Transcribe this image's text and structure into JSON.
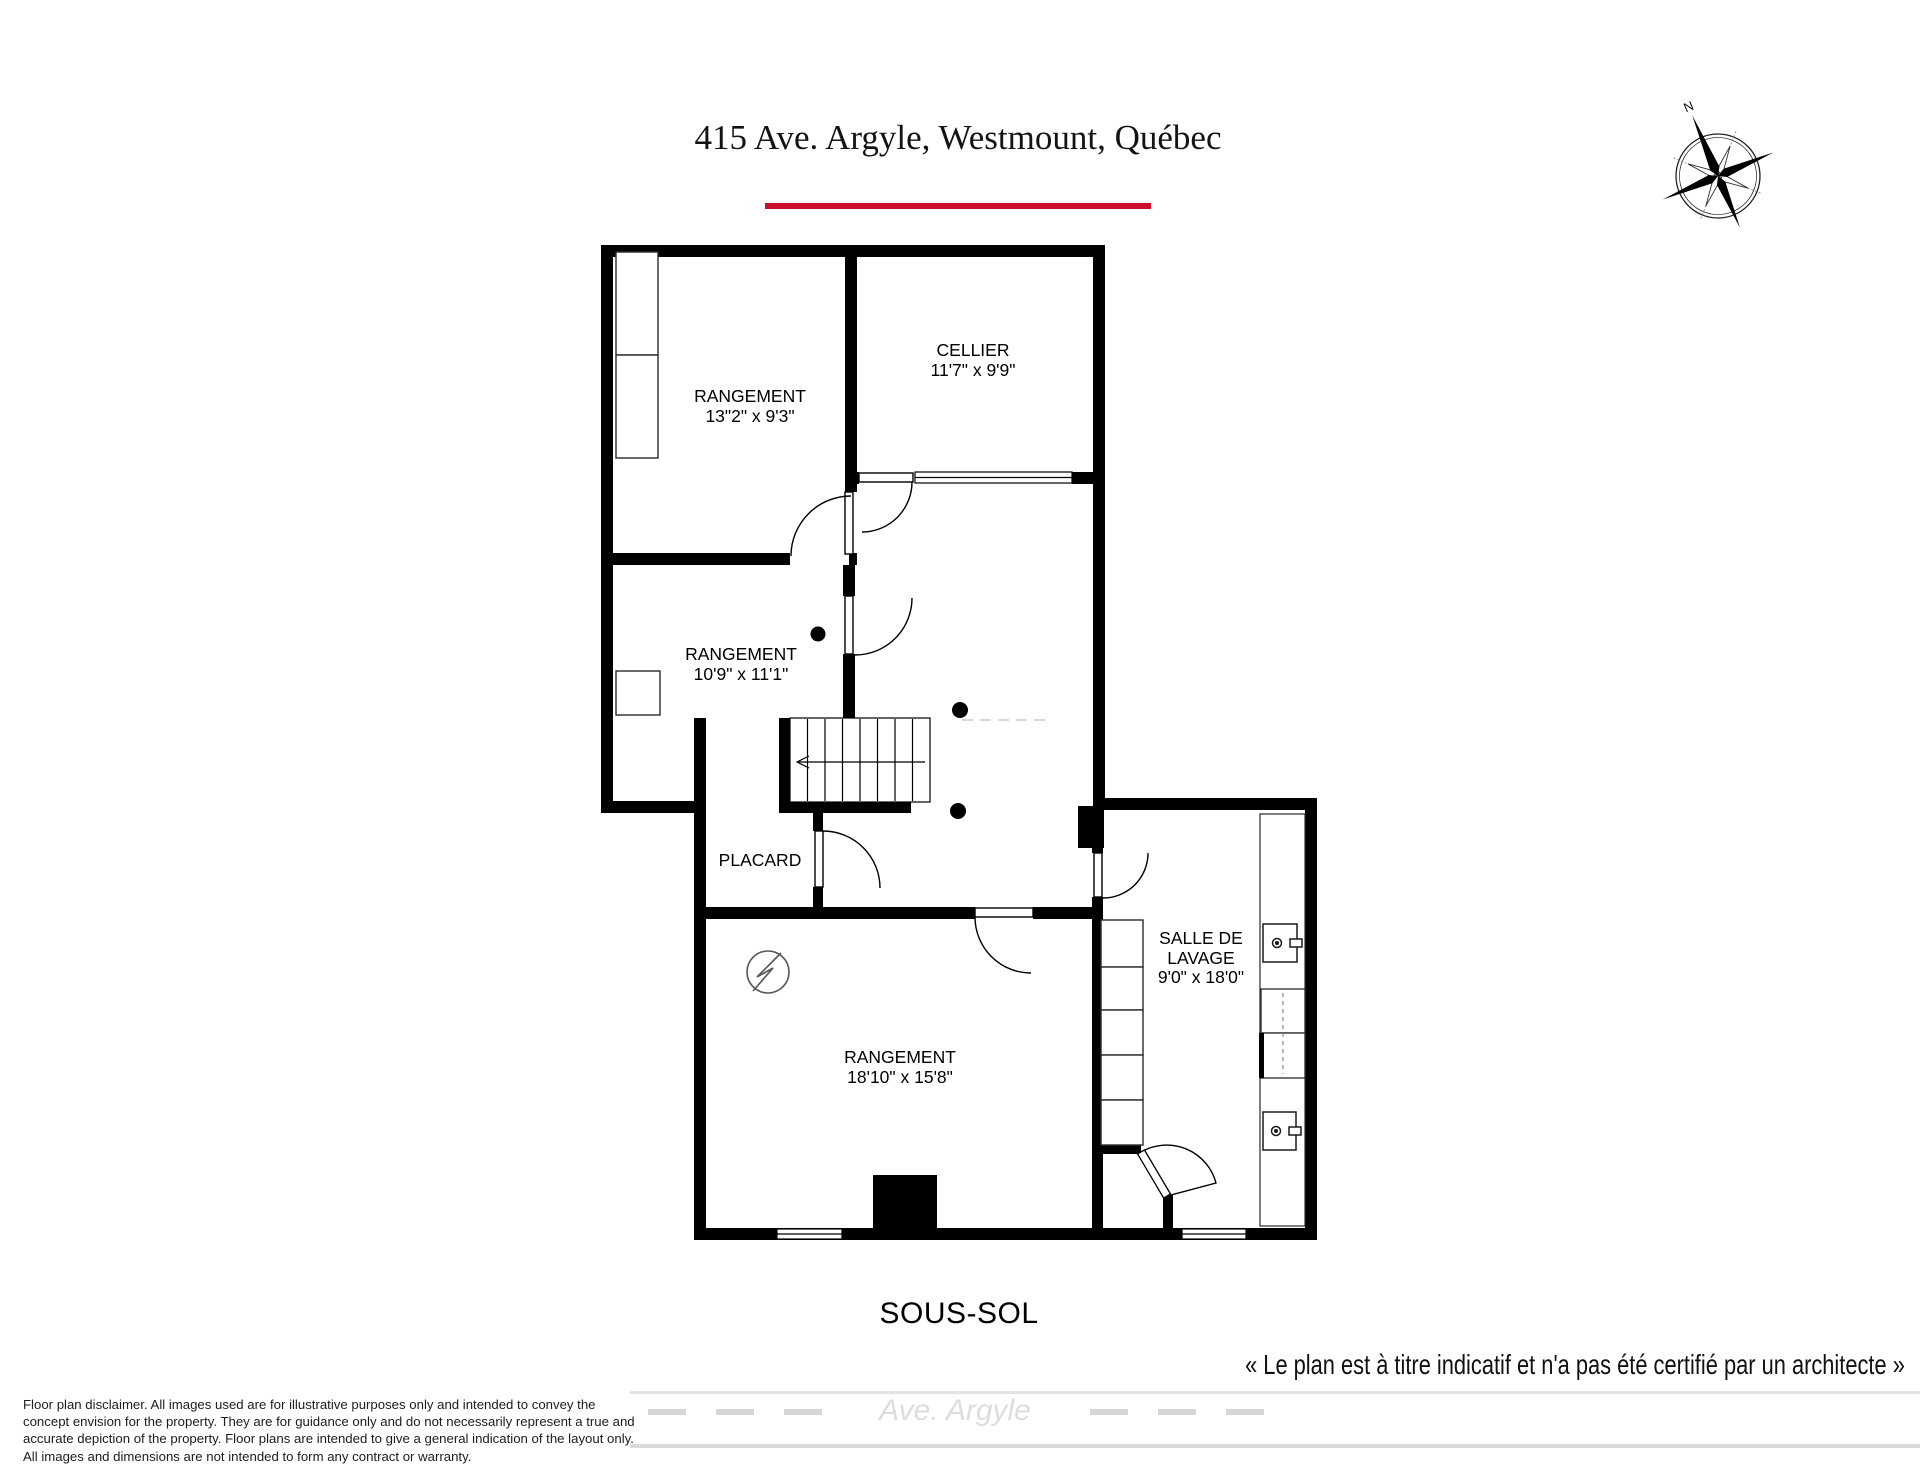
{
  "header": {
    "title": "415 Ave. Argyle, Westmount, Québec",
    "accent_color": "#c8102e"
  },
  "compass": {
    "north_label": "N"
  },
  "rooms": [
    {
      "name": "RANGEMENT",
      "dimensions": "13\"2\" x 9'3\""
    },
    {
      "name": "CELLIER",
      "dimensions": "11'7\" x 9'9\""
    },
    {
      "name": "RANGEMENT",
      "dimensions": "10'9\" x 11'1\""
    },
    {
      "name": "PLACARD",
      "dimensions": ""
    },
    {
      "name": "RANGEMENT",
      "dimensions": "18'10\" x 15'8\""
    },
    {
      "name": "SALLE DE LAVAGE",
      "dimensions": "9'0\" x 18'0\""
    }
  ],
  "floor_label": "SOUS-SOL",
  "certification_note": "« Le plan est à titre indicatif et n'a pas été certifié par un architecte »",
  "street_label": "Ave. Argyle",
  "disclaimer_lines": [
    "Floor plan disclaimer. All images used are for illustrative purposes only and intended to convey the",
    "concept envision for the property. They are for guidance only and do not necessarily represent a true and",
    "accurate depiction of the property. Floor plans are intended to give a general indication of the layout only.",
    "All images and dimensions are not intended to form any contract or warranty."
  ]
}
